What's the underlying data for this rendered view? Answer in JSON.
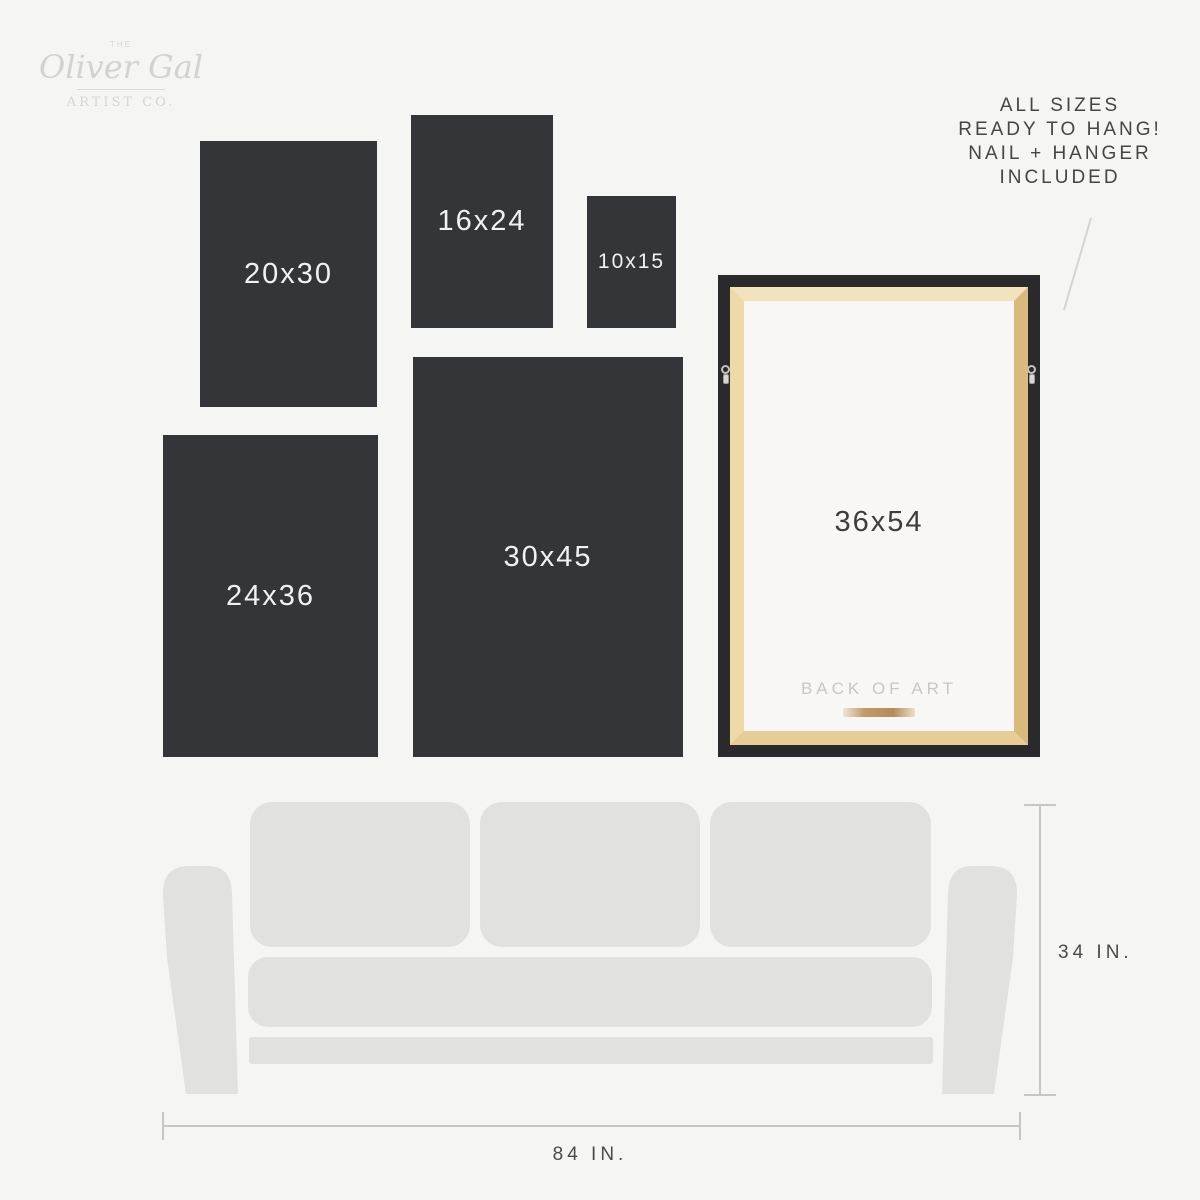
{
  "brand": {
    "prefix": "THE",
    "name": "Oliver Gal",
    "suffix": "ARTIST CO."
  },
  "note": "ALL SIZES\nREADY TO HANG!\nNAIL + HANGER\nINCLUDED",
  "sizes": [
    {
      "label": "20x30"
    },
    {
      "label": "16x24"
    },
    {
      "label": "10x15"
    },
    {
      "label": "24x36"
    },
    {
      "label": "30x45"
    }
  ],
  "frame": {
    "label": "36x54",
    "back_label": "BACK OF ART"
  },
  "dims": {
    "height": "34 IN.",
    "width": "84 IN."
  },
  "colors": {
    "background": "#f5f5f3",
    "size_box": "#343539",
    "size_box_text": "#f1f1f1",
    "couch": "#e1e1df",
    "dim_line": "#c6c6c4",
    "leader_line": "#d4d4d2",
    "note_text": "#454545",
    "logo_gray": "#d5d4d1",
    "frame_black": "#2a2a2c",
    "wood_light": "#f0e3bd",
    "wood_dark": "#d9b97c",
    "canvas_back": "#f8f7f5",
    "back_label_text": "#c7c7c7"
  }
}
